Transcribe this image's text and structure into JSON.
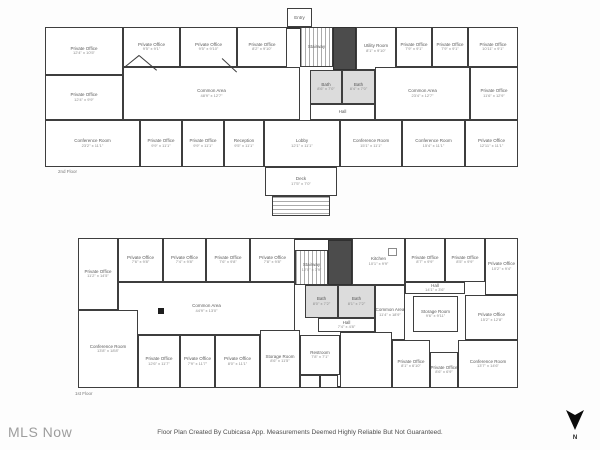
{
  "watermark": "MLS Now",
  "caption": "Floor Plan Created By Cubicasa App. Measurements Deemed Highly Reliable But Not Guaranteed.",
  "compass": {
    "label": "N"
  },
  "colors": {
    "wall": "#3e3e3e",
    "bath_fill": "#dcdcdc",
    "elevator_fill": "#4c4c4c",
    "watermark": "#9d9d9d"
  },
  "floors": [
    {
      "name": "2nd Floor",
      "label_pos": {
        "x": 58,
        "y": 169
      },
      "outline": {
        "x": 45,
        "y": 27,
        "w": 473,
        "h": 140
      },
      "rooms": [
        {
          "l": "Private Office",
          "d": "12'4\" x 10'5\"",
          "x": 45,
          "y": 27,
          "w": 78,
          "h": 48
        },
        {
          "l": "Private Office",
          "d": "9'5\" x 9'1\"",
          "x": 123,
          "y": 27,
          "w": 57,
          "h": 40
        },
        {
          "l": "Private Office",
          "d": "9'5\" x 9'10\"",
          "x": 180,
          "y": 27,
          "w": 57,
          "h": 40
        },
        {
          "l": "Private Office",
          "d": "8'2\" x 9'10\"",
          "x": 237,
          "y": 27,
          "w": 50,
          "h": 40
        },
        {
          "l": "Entry",
          "d": "",
          "x": 287,
          "y": 8,
          "w": 25,
          "h": 19
        },
        {
          "l": "Stairway",
          "d": "",
          "x": 300,
          "y": 27,
          "w": 33,
          "h": 40,
          "t": "stairs-v"
        },
        {
          "l": "",
          "d": "",
          "x": 333,
          "y": 27,
          "w": 23,
          "h": 43,
          "t": "elevator"
        },
        {
          "l": "Utility Room",
          "d": "8'1\" x 9'10\"",
          "x": 356,
          "y": 27,
          "w": 40,
          "h": 43
        },
        {
          "l": "Private Office",
          "d": "7'9\" x 9'1\"",
          "x": 396,
          "y": 27,
          "w": 36,
          "h": 40
        },
        {
          "l": "Private Office",
          "d": "7'9\" x 9'1\"",
          "x": 432,
          "y": 27,
          "w": 36,
          "h": 40
        },
        {
          "l": "Private Office",
          "d": "10'11\" x 9'1\"",
          "x": 468,
          "y": 27,
          "w": 50,
          "h": 40
        },
        {
          "l": "Common Area",
          "d": "48'9\" x 12'7\"",
          "x": 123,
          "y": 67,
          "w": 177,
          "h": 53
        },
        {
          "l": "Private Office",
          "d": "12'4\" x 9'9\"",
          "x": 45,
          "y": 75,
          "w": 78,
          "h": 45
        },
        {
          "l": "Bath",
          "d": "8'6\" x 7'0\"",
          "x": 310,
          "y": 70,
          "w": 32,
          "h": 34,
          "t": "bath"
        },
        {
          "l": "Bath",
          "d": "8'4\" x 7'0\"",
          "x": 342,
          "y": 70,
          "w": 33,
          "h": 34,
          "t": "bath"
        },
        {
          "l": "Hall",
          "d": "",
          "x": 310,
          "y": 104,
          "w": 65,
          "h": 16
        },
        {
          "l": "Common Area",
          "d": "23'4\" x 12'7\"",
          "x": 375,
          "y": 67,
          "w": 95,
          "h": 53
        },
        {
          "l": "Private Office",
          "d": "11'6\" x 12'9\"",
          "x": 470,
          "y": 67,
          "w": 48,
          "h": 53
        },
        {
          "l": "Conference Room",
          "d": "23'2\" x 11'1\"",
          "x": 45,
          "y": 120,
          "w": 95,
          "h": 47
        },
        {
          "l": "Private Office",
          "d": "9'9\" x 11'1\"",
          "x": 140,
          "y": 120,
          "w": 42,
          "h": 47
        },
        {
          "l": "Private Office",
          "d": "9'9\" x 11'1\"",
          "x": 182,
          "y": 120,
          "w": 42,
          "h": 47
        },
        {
          "l": "Reception",
          "d": "9'5\" x 11'1\"",
          "x": 224,
          "y": 120,
          "w": 40,
          "h": 47
        },
        {
          "l": "Lobby",
          "d": "12'1\" x 11'1\"",
          "x": 264,
          "y": 120,
          "w": 76,
          "h": 47
        },
        {
          "l": "Conference Room",
          "d": "15'1\" x 11'1\"",
          "x": 340,
          "y": 120,
          "w": 62,
          "h": 47
        },
        {
          "l": "Conference Room",
          "d": "15'4\" x 11'1\"",
          "x": 402,
          "y": 120,
          "w": 63,
          "h": 47
        },
        {
          "l": "Private Office",
          "d": "12'11\" x 11'1\"",
          "x": 465,
          "y": 120,
          "w": 53,
          "h": 47
        },
        {
          "l": "Deck",
          "d": "17'5\" x 7'0\"",
          "x": 265,
          "y": 167,
          "w": 72,
          "h": 29
        },
        {
          "l": "",
          "d": "",
          "x": 272,
          "y": 196,
          "w": 58,
          "h": 20,
          "t": "stairs-h"
        }
      ],
      "diagonals": [
        {
          "x": 123,
          "y": 68,
          "len": 21,
          "rot": -39
        },
        {
          "x": 139,
          "y": 55,
          "len": 23,
          "rot": 40
        },
        {
          "x": 222,
          "y": 58,
          "len": 20,
          "rot": 43
        }
      ]
    },
    {
      "name": "1st Floor",
      "label_pos": {
        "x": 75,
        "y": 391
      },
      "outline": {
        "x": 78,
        "y": 238,
        "w": 440,
        "h": 150
      },
      "rooms": [
        {
          "l": "Private Office",
          "d": "11'2\" x 14'5\"",
          "x": 78,
          "y": 238,
          "w": 40,
          "h": 72
        },
        {
          "l": "Private Office",
          "d": "7'6\" x 9'8\"",
          "x": 118,
          "y": 238,
          "w": 45,
          "h": 44
        },
        {
          "l": "Private Office",
          "d": "7'4\" x 9'8\"",
          "x": 163,
          "y": 238,
          "w": 43,
          "h": 44
        },
        {
          "l": "Private Office",
          "d": "7'6\" x 9'8\"",
          "x": 206,
          "y": 238,
          "w": 44,
          "h": 44
        },
        {
          "l": "Private Office",
          "d": "7'8\" x 9'8\"",
          "x": 250,
          "y": 238,
          "w": 45,
          "h": 44
        },
        {
          "l": "Stairway",
          "d": "12'0\" x 3'9\"",
          "x": 295,
          "y": 250,
          "w": 33,
          "h": 35,
          "t": "stairs-v"
        },
        {
          "l": "",
          "d": "",
          "x": 328,
          "y": 240,
          "w": 24,
          "h": 45,
          "t": "elevator"
        },
        {
          "l": "Kitchen",
          "d": "10'1\" x 9'9\"",
          "x": 352,
          "y": 238,
          "w": 53,
          "h": 47
        },
        {
          "l": "",
          "d": "",
          "x": 388,
          "y": 248,
          "w": 9,
          "h": 8,
          "t": "fixture"
        },
        {
          "l": "Private Office",
          "d": "8'7\" x 9'9\"",
          "x": 405,
          "y": 238,
          "w": 40,
          "h": 44
        },
        {
          "l": "Private Office",
          "d": "8'5\" x 9'9\"",
          "x": 445,
          "y": 238,
          "w": 40,
          "h": 44
        },
        {
          "l": "Private Office",
          "d": "10'2\" x 9'4\"",
          "x": 485,
          "y": 238,
          "w": 33,
          "h": 57
        },
        {
          "l": "Common Area",
          "d": "44'9\" x 13'0\"",
          "x": 118,
          "y": 282,
          "w": 177,
          "h": 53
        },
        {
          "l": "",
          "d": "",
          "x": 158,
          "y": 308,
          "w": 6,
          "h": 6,
          "t": "column"
        },
        {
          "l": "Bath",
          "d": "8'0\" x 7'2\"",
          "x": 305,
          "y": 285,
          "w": 33,
          "h": 33,
          "t": "bath"
        },
        {
          "l": "Bath",
          "d": "8'1\" x 7'2\"",
          "x": 338,
          "y": 285,
          "w": 37,
          "h": 33,
          "t": "bath"
        },
        {
          "l": "Hall",
          "d": "7'4\" x 4'8\"",
          "x": 318,
          "y": 318,
          "w": 57,
          "h": 14
        },
        {
          "l": "Common Area",
          "d": "11'4\" x 18'9\"",
          "x": 375,
          "y": 285,
          "w": 30,
          "h": 55
        },
        {
          "l": "Hall",
          "d": "14'1\" x 3'6\"",
          "x": 405,
          "y": 282,
          "w": 60,
          "h": 12
        },
        {
          "l": "Storage Room",
          "d": "9'6\" x 9'11\"",
          "x": 413,
          "y": 296,
          "w": 45,
          "h": 36
        },
        {
          "l": "Private Office",
          "d": "15'2\" x 12'8\"",
          "x": 465,
          "y": 295,
          "w": 53,
          "h": 45
        },
        {
          "l": "Conference Room",
          "d": "13'8\" x 18'8\"",
          "x": 78,
          "y": 310,
          "w": 60,
          "h": 78
        },
        {
          "l": "Private Office",
          "d": "12'6\" x 11'7\"",
          "x": 138,
          "y": 335,
          "w": 42,
          "h": 53
        },
        {
          "l": "Private Office",
          "d": "7'9\" x 11'7\"",
          "x": 180,
          "y": 335,
          "w": 35,
          "h": 53
        },
        {
          "l": "Private Office",
          "d": "8'0\" x 11'1\"",
          "x": 215,
          "y": 335,
          "w": 45,
          "h": 53
        },
        {
          "l": "Storage Room",
          "d": "8'6\" x 11'5\"",
          "x": 260,
          "y": 330,
          "w": 40,
          "h": 58
        },
        {
          "l": "Restroom",
          "d": "7'8\" x 7'1\"",
          "x": 300,
          "y": 335,
          "w": 40,
          "h": 40
        },
        {
          "l": "",
          "d": "",
          "x": 300,
          "y": 375,
          "w": 20,
          "h": 13
        },
        {
          "l": "",
          "d": "",
          "x": 320,
          "y": 375,
          "w": 18,
          "h": 13
        },
        {
          "l": "",
          "d": "",
          "x": 340,
          "y": 332,
          "w": 52,
          "h": 56
        },
        {
          "l": "Private Office",
          "d": "8'1\" x 6'10\"",
          "x": 392,
          "y": 340,
          "w": 38,
          "h": 48
        },
        {
          "l": "Private Office",
          "d": "8'6\" x 6'9\"",
          "x": 430,
          "y": 352,
          "w": 28,
          "h": 36
        },
        {
          "l": "Conference Room",
          "d": "13'7\" x 14'6\"",
          "x": 458,
          "y": 340,
          "w": 60,
          "h": 48
        }
      ],
      "diagonals": []
    }
  ]
}
